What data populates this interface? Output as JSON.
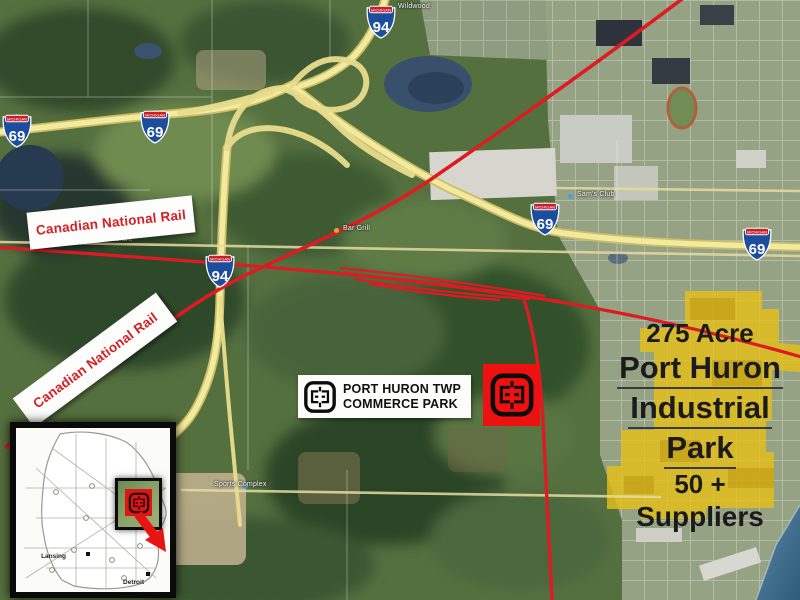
{
  "highway_shields": {
    "state_label": "MICHIGAN",
    "i69_number": "69",
    "i94_number": "94"
  },
  "rail_banners": {
    "label": "Canadian National Rail"
  },
  "commerce_park_label": {
    "line1": "PORT HURON TWP",
    "line2": "COMMERCE PARK"
  },
  "industrial_park_callout": {
    "acreage": "275 Acre",
    "name_line1": "Port Huron",
    "name_line2": "Industrial",
    "name_line3": "Park",
    "suppliers_count": "50 +",
    "suppliers_word": "Suppliers"
  },
  "map_poi_labels": {
    "sams_club": "Sam's Club",
    "crossroads_restaurant": "Crossroads Restaurant",
    "bar_grill": "Bar Grill",
    "sports_complex": "Sports Complex",
    "wildwood": "Wildwood"
  },
  "inset_map": {
    "city1": "Lansing",
    "city2": "Detroit"
  },
  "colors": {
    "rail_red": "#dd1b22",
    "banner_text_red": "#d42127",
    "highway_yellow": "#f2ea9e",
    "park_highlight": "#e7bf17",
    "shield_blue": "#1d4e9e",
    "shield_band_red": "#c6202c",
    "marker_red": "#ee1111",
    "water_blue": "#44789b"
  }
}
